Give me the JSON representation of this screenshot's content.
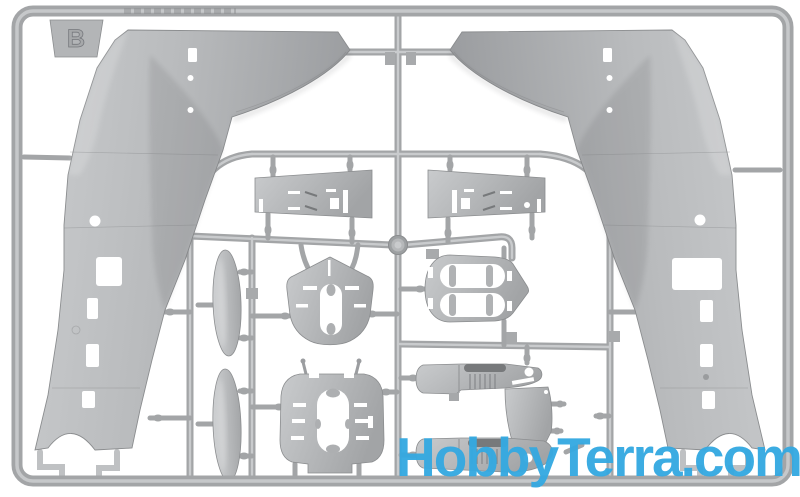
{
  "photo": {
    "subject": "Injection-molded scale model kit sprue (frame B) with aircraft fuselage halves, wings and interior parts in light gray plastic on a white background",
    "background_color": "#ffffff"
  },
  "sprue": {
    "letter": "B",
    "plastic_color": "#b3b5b7",
    "runner_color": "#a3a5a7",
    "highlight_color": "#c9cbcd",
    "part_edge_color": "#8b8d8f",
    "dark_detail_color": "#77797b"
  },
  "watermark": {
    "text": "HobbyTerra.com",
    "color": "#35a9e1"
  }
}
